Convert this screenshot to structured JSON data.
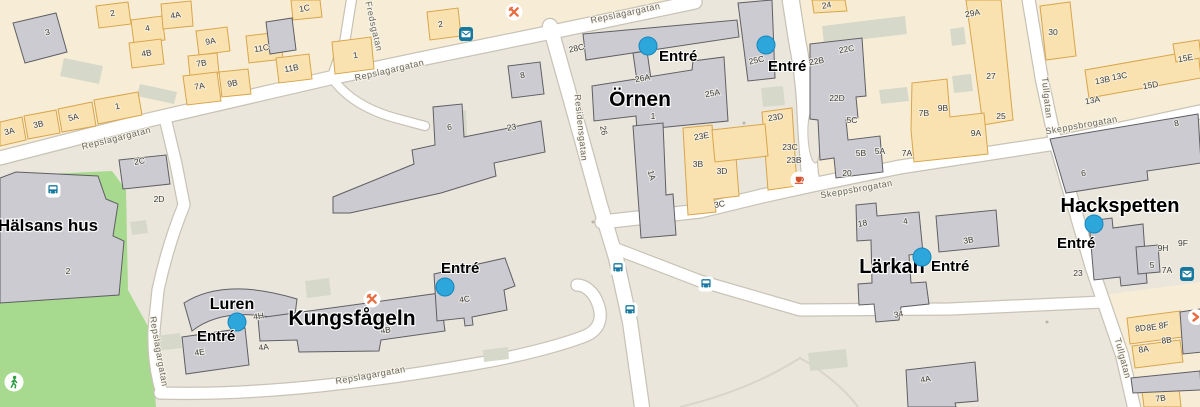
{
  "map": {
    "colors": {
      "base": "#EAE6DC",
      "residential": "#F7EDD6",
      "park": "#A7DA8E",
      "road": "#FFFFFF",
      "road_casing": "#C9C3B6",
      "building_gray": "#CBCBD1",
      "building_orange": "#F9E2B0",
      "building_orange_stroke": "#D8A54B",
      "entrance_blue": "#2CA6DB",
      "transit_teal": "#15789E",
      "poi_orange": "#E96B3F",
      "walk_green": "#2F9E44"
    }
  },
  "quarters": [
    {
      "name": "Örnen",
      "x": 640,
      "y": 106,
      "size": 21
    },
    {
      "name": "Kungsfågeln",
      "x": 352,
      "y": 325,
      "size": 21
    },
    {
      "name": "Lärkan",
      "x": 892,
      "y": 273,
      "size": 20
    },
    {
      "name": "Hackspetten",
      "x": 1120,
      "y": 212,
      "size": 20
    },
    {
      "name": "Hälsans hus",
      "x": 48,
      "y": 231,
      "size": 17
    },
    {
      "name": "Luren",
      "x": 232,
      "y": 309,
      "size": 16
    }
  ],
  "streets": [
    {
      "name": "Repslagargatan",
      "x": 117,
      "y": 141,
      "r": -14
    },
    {
      "name": "Repslagargatan",
      "x": 390,
      "y": 73,
      "r": -13
    },
    {
      "name": "Repslagargatan",
      "x": 626,
      "y": 16,
      "r": -12
    },
    {
      "name": "Repslagargatan",
      "x": 156,
      "y": 352,
      "r": 80
    },
    {
      "name": "Repslagargatan",
      "x": 371,
      "y": 378,
      "r": -10
    },
    {
      "name": "Fredsgatan",
      "x": 371,
      "y": 27,
      "r": 77
    },
    {
      "name": "Residensgatan",
      "x": 578,
      "y": 128,
      "r": 84
    },
    {
      "name": "Skeppsbrogatan",
      "x": 857,
      "y": 192,
      "r": -10
    },
    {
      "name": "Skeppsbrogatan",
      "x": 1082,
      "y": 128,
      "r": -10
    },
    {
      "name": "Tullgatan",
      "x": 1044,
      "y": 98,
      "r": 84
    },
    {
      "name": "Tullgatan",
      "x": 1120,
      "y": 359,
      "r": 75
    }
  ],
  "entrances": [
    {
      "label": "Entré",
      "dx": 648,
      "dy": 46,
      "tx": 659,
      "ty": 61
    },
    {
      "label": "Entré",
      "dx": 766,
      "dy": 45,
      "tx": 768,
      "ty": 71
    },
    {
      "label": "Entré",
      "dx": 445,
      "dy": 287,
      "tx": 441,
      "ty": 273
    },
    {
      "label": "Entré",
      "dx": 237,
      "dy": 322,
      "tx": 197,
      "ty": 341
    },
    {
      "label": "Entré",
      "dx": 922,
      "dy": 257,
      "tx": 931,
      "ty": 271
    },
    {
      "label": "Entré",
      "dx": 1094,
      "dy": 224,
      "tx": 1057,
      "ty": 248
    }
  ],
  "numbers": [
    {
      "t": "3",
      "x": 48,
      "y": 35,
      "r": -10
    },
    {
      "t": "2",
      "x": 113,
      "y": 16,
      "r": -10
    },
    {
      "t": "4",
      "x": 148,
      "y": 31,
      "r": -10
    },
    {
      "t": "4A",
      "x": 176,
      "y": 18,
      "r": -10
    },
    {
      "t": "4B",
      "x": 147,
      "y": 56,
      "r": -10
    },
    {
      "t": "9A",
      "x": 211,
      "y": 44,
      "r": -10
    },
    {
      "t": "7B",
      "x": 202,
      "y": 66,
      "r": -10
    },
    {
      "t": "7A",
      "x": 200,
      "y": 89,
      "r": -10
    },
    {
      "t": "9B",
      "x": 233,
      "y": 86,
      "r": -10
    },
    {
      "t": "11C",
      "x": 262,
      "y": 51,
      "r": -10
    },
    {
      "t": "11B",
      "x": 292,
      "y": 71,
      "r": -10
    },
    {
      "t": "1C",
      "x": 305,
      "y": 11,
      "r": -10
    },
    {
      "t": "1",
      "x": 356,
      "y": 58,
      "r": -10
    },
    {
      "t": "2",
      "x": 441,
      "y": 27,
      "r": -10
    },
    {
      "t": "3A",
      "x": 10,
      "y": 134,
      "r": -12
    },
    {
      "t": "3B",
      "x": 39,
      "y": 127,
      "r": -12
    },
    {
      "t": "5A",
      "x": 74,
      "y": 120,
      "r": -12
    },
    {
      "t": "1",
      "x": 118,
      "y": 109,
      "r": -12
    },
    {
      "t": "2C",
      "x": 140,
      "y": 164,
      "r": -10
    },
    {
      "t": "2D",
      "x": 159,
      "y": 202,
      "r": 0
    },
    {
      "t": "2",
      "x": 68,
      "y": 274,
      "r": 0
    },
    {
      "t": "8",
      "x": 523,
      "y": 78,
      "r": -10
    },
    {
      "t": "6",
      "x": 450,
      "y": 130,
      "r": -10
    },
    {
      "t": "23",
      "x": 512,
      "y": 130,
      "r": -10
    },
    {
      "t": "28C",
      "x": 577,
      "y": 51,
      "r": -12
    },
    {
      "t": "26A",
      "x": 643,
      "y": 81,
      "r": -10
    },
    {
      "t": "25A",
      "x": 713,
      "y": 96,
      "r": -10
    },
    {
      "t": "25C",
      "x": 757,
      "y": 63,
      "r": -12
    },
    {
      "t": "26",
      "x": 601,
      "y": 131,
      "r": 78
    },
    {
      "t": "1",
      "x": 653,
      "y": 119,
      "r": 0
    },
    {
      "t": "1A",
      "x": 649,
      "y": 176,
      "r": 75
    },
    {
      "t": "23E",
      "x": 702,
      "y": 139,
      "r": -10
    },
    {
      "t": "23D",
      "x": 776,
      "y": 120,
      "r": -10
    },
    {
      "t": "23C",
      "x": 790,
      "y": 150,
      "r": 0
    },
    {
      "t": "23B",
      "x": 794,
      "y": 163,
      "r": 0
    },
    {
      "t": "3B",
      "x": 698,
      "y": 167,
      "r": 0
    },
    {
      "t": "3D",
      "x": 722,
      "y": 174,
      "r": 0
    },
    {
      "t": "3C",
      "x": 720,
      "y": 207,
      "r": -10
    },
    {
      "t": "24",
      "x": 827,
      "y": 8,
      "r": -10
    },
    {
      "t": "22B",
      "x": 817,
      "y": 64,
      "r": -10
    },
    {
      "t": "22C",
      "x": 847,
      "y": 52,
      "r": -10
    },
    {
      "t": "22D",
      "x": 837,
      "y": 101,
      "r": 0
    },
    {
      "t": "5C",
      "x": 852,
      "y": 123,
      "r": 0
    },
    {
      "t": "5B",
      "x": 861,
      "y": 156,
      "r": 0
    },
    {
      "t": "5A",
      "x": 880,
      "y": 154,
      "r": 0
    },
    {
      "t": "20",
      "x": 847,
      "y": 176,
      "r": 0
    },
    {
      "t": "29A",
      "x": 973,
      "y": 16,
      "r": -10
    },
    {
      "t": "27",
      "x": 991,
      "y": 79,
      "r": 0
    },
    {
      "t": "25",
      "x": 1001,
      "y": 119,
      "r": 0
    },
    {
      "t": "30",
      "x": 1053,
      "y": 35,
      "r": 0
    },
    {
      "t": "7B",
      "x": 924,
      "y": 116,
      "r": 0
    },
    {
      "t": "9B",
      "x": 943,
      "y": 111,
      "r": 0
    },
    {
      "t": "9A",
      "x": 976,
      "y": 136,
      "r": 0
    },
    {
      "t": "7A",
      "x": 907,
      "y": 156,
      "r": 0
    },
    {
      "t": "13B",
      "x": 1103,
      "y": 83,
      "r": -10
    },
    {
      "t": "13C",
      "x": 1120,
      "y": 79,
      "r": -10
    },
    {
      "t": "15D",
      "x": 1151,
      "y": 88,
      "r": -10
    },
    {
      "t": "15E",
      "x": 1186,
      "y": 61,
      "r": -10
    },
    {
      "t": "13A",
      "x": 1093,
      "y": 103,
      "r": -10
    },
    {
      "t": "8",
      "x": 1177,
      "y": 126,
      "r": -10
    },
    {
      "t": "6",
      "x": 1084,
      "y": 176,
      "r": -10
    },
    {
      "t": "18",
      "x": 863,
      "y": 226,
      "r": -10
    },
    {
      "t": "4",
      "x": 906,
      "y": 224,
      "r": -10
    },
    {
      "t": "3B",
      "x": 969,
      "y": 243,
      "r": -10
    },
    {
      "t": "34",
      "x": 899,
      "y": 317,
      "r": -10
    },
    {
      "t": "4A",
      "x": 926,
      "y": 382,
      "r": -10
    },
    {
      "t": "23",
      "x": 1078,
      "y": 276,
      "r": 0
    },
    {
      "t": "5",
      "x": 1152,
      "y": 268,
      "r": 0
    },
    {
      "t": "9H",
      "x": 1163,
      "y": 251,
      "r": 0
    },
    {
      "t": "9F",
      "x": 1183,
      "y": 246,
      "r": 0
    },
    {
      "t": "7A",
      "x": 1167,
      "y": 273,
      "r": 0
    },
    {
      "t": "8D",
      "x": 1141,
      "y": 331,
      "r": -8
    },
    {
      "t": "8E",
      "x": 1152,
      "y": 330,
      "r": -8
    },
    {
      "t": "8F",
      "x": 1164,
      "y": 328,
      "r": -8
    },
    {
      "t": "8A",
      "x": 1144,
      "y": 352,
      "r": -8
    },
    {
      "t": "8B",
      "x": 1167,
      "y": 343,
      "r": -8
    },
    {
      "t": "7B",
      "x": 1161,
      "y": 401,
      "r": -8
    },
    {
      "t": "4H",
      "x": 259,
      "y": 319,
      "r": -8
    },
    {
      "t": "4E",
      "x": 200,
      "y": 355,
      "r": -8
    },
    {
      "t": "4A",
      "x": 264,
      "y": 350,
      "r": -8
    },
    {
      "t": "4B",
      "x": 386,
      "y": 333,
      "r": -8
    },
    {
      "t": "4C",
      "x": 465,
      "y": 302,
      "r": -8
    }
  ],
  "icons": [
    {
      "type": "bus-stop",
      "x": 53,
      "y": 190
    },
    {
      "type": "bus-stop",
      "x": 618,
      "y": 268
    },
    {
      "type": "bus-stop",
      "x": 630,
      "y": 310
    },
    {
      "type": "bus-stop",
      "x": 706,
      "y": 284
    },
    {
      "type": "restaurant",
      "x": 514,
      "y": 12
    },
    {
      "type": "restaurant",
      "x": 372,
      "y": 299
    },
    {
      "type": "cafe",
      "x": 799,
      "y": 180
    },
    {
      "type": "mail",
      "x": 466,
      "y": 34
    },
    {
      "type": "mail",
      "x": 1187,
      "y": 274
    },
    {
      "type": "walking",
      "x": 14,
      "y": 382
    },
    {
      "type": "chevron",
      "x": 1196,
      "y": 317
    }
  ]
}
